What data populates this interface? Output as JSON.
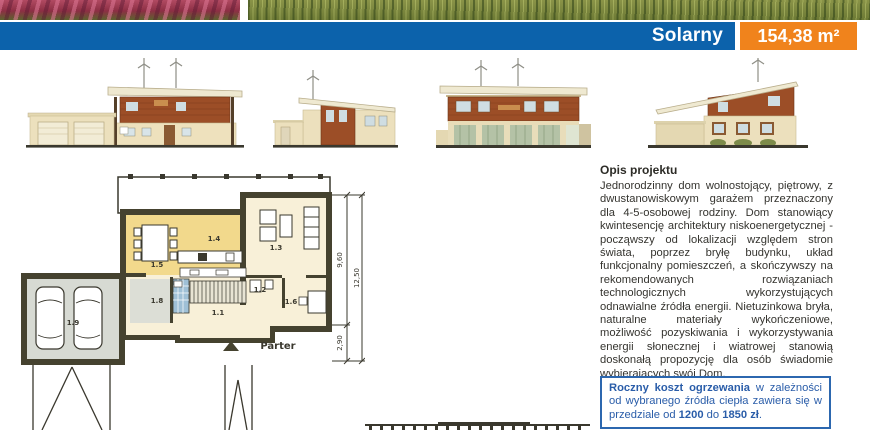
{
  "header": {
    "project_name": "Solarny",
    "area": "154,38 m²"
  },
  "description": {
    "heading": "Opis projektu",
    "body": "Jednorodzinny dom wolnostojący, piętrowy, z dwustanowiskowym garażem przeznaczony dla 4-5-osobowej rodziny. Dom stanowiący kwintesencję architektury niskoenergetycznej - począwszy od lokalizacji względem stron świata, poprzez bryłę budynku, układ funkcjonalny pomieszczeń, a skończywszy na rekomendowanych rozwiązaniach technologicznych wykorzystujących odnawialne źródła energii. Nietuzinkowa bryła, naturalne materiały wykończeniowe, możliwość pozyskiwania i wykorzystywania energii słonecznej i wiatrowej stanowią doskonałą propozycję dla osób świadomie wybierających swój Dom."
  },
  "info_box": {
    "lead": "Roczny koszt ogrzewania",
    "mid1": " w zależności od wybranego źródła ciepła zawiera się w przedziale od ",
    "value1": "1200",
    "mid2": " do ",
    "value2": "1850 zł",
    "end": "."
  },
  "floor_plan": {
    "title": "Parter",
    "rooms": [
      "1.1",
      "1.2",
      "1.3",
      "1.4",
      "1.5",
      "1.6",
      "1.8",
      "1.9"
    ],
    "dim_height": "9,60",
    "dim_total": "12,50",
    "dim_garage": "2,90"
  },
  "colors": {
    "accent_blue": "#0c62ab",
    "accent_orange": "#f0831c",
    "info_blue": "#2c67af",
    "plan_wall": "#45422f",
    "plan_yellow": "#f2d98c",
    "plan_cream": "#f8f0d8",
    "plan_gray": "#d7dad3",
    "elevation_wood": "#9c4e27"
  }
}
